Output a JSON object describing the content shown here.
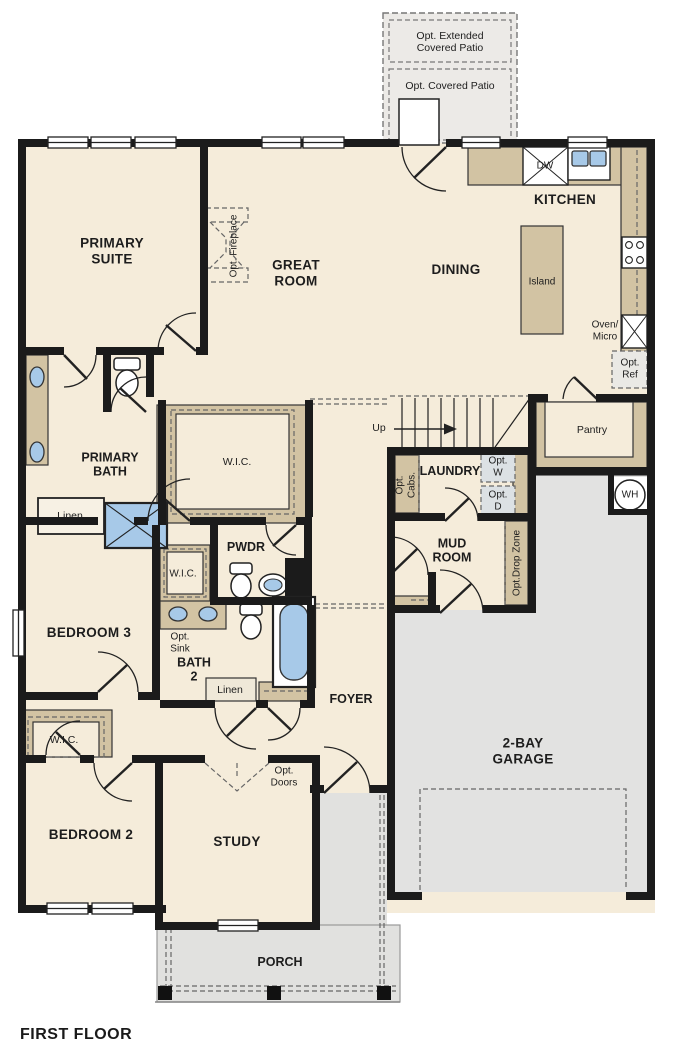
{
  "title": "FIRST FLOOR",
  "colors": {
    "floor_cream": "#f5ecda",
    "wall_black": "#1b1b1b",
    "counter_tan": "#d2c3a3",
    "garage_gray": "#e2e2e1",
    "porch_gray": "#e1e1df",
    "patio_gray": "#eceae7",
    "fixture_blue": "#a7c9e8",
    "opt_appliance_gray": "#dce1e4"
  },
  "labels": {
    "opt_extended_patio": "Opt. Extended\nCovered Patio",
    "opt_covered_patio": "Opt. Covered Patio",
    "kitchen": "KITCHEN",
    "dw": "DW",
    "island": "Island",
    "dining": "DINING",
    "great_room": "GREAT\nROOM",
    "primary_suite": "PRIMARY\nSUITE",
    "opt_fireplace": "Opt. Fireplace",
    "oven_micro": "Oven/\nMicro",
    "opt_ref": "Opt.\nRef",
    "pantry": "Pantry",
    "wh": "WH",
    "up": "Up",
    "opt_cabs": "Opt.\nCabs.",
    "laundry": "LAUNDRY",
    "opt_w": "Opt.\nW",
    "opt_d": "Opt.\nD",
    "primary_bath": "PRIMARY\nBATH",
    "linen_primary": "Linen",
    "wic_primary": "W.I.C.",
    "pwdr": "PWDR",
    "wic_bed3": "W.I.C.",
    "mud_room": "MUD\nROOM",
    "opt_drop_zone": "Opt.Drop Zone",
    "bedroom3": "BEDROOM 3",
    "opt_sink": "Opt.\nSink",
    "bath2": "BATH\n2",
    "linen_bath2": "Linen",
    "foyer": "FOYER",
    "garage": "2-BAY\nGARAGE",
    "wic_bed2": "W.I.C.",
    "bedroom2": "BEDROOM 2",
    "study": "STUDY",
    "opt_doors": "Opt.\nDoors",
    "porch": "PORCH",
    "first_floor": "FIRST FLOOR"
  }
}
